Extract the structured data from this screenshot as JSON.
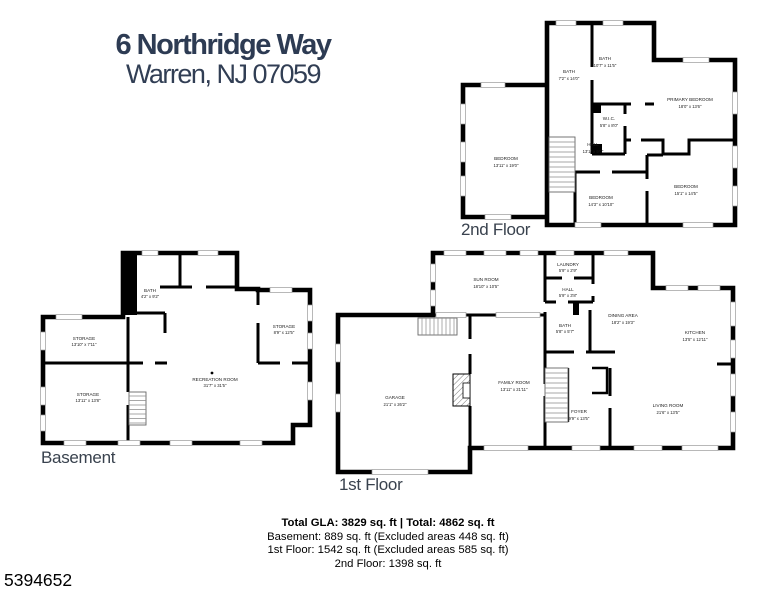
{
  "title": {
    "line1": "6 Northridge Way",
    "line2": "Warren, NJ 07059"
  },
  "colors": {
    "title_text": "#2d3b53",
    "floor_label_text": "#39424e",
    "walls": "#000000",
    "background": "#ffffff"
  },
  "floors": {
    "second": {
      "label": "2nd Floor",
      "rooms": [
        {
          "name": "BATH",
          "dims": "7'2\" x 14'0\""
        },
        {
          "name": "BATH",
          "dims": "10'7\" x 11'5\""
        },
        {
          "name": "PRIMARY BEDROOM",
          "dims": "18'0\" x 13'6\""
        },
        {
          "name": "W.I.C.",
          "dims": "5'8\" x 8'0\""
        },
        {
          "name": "HALL",
          "dims": "13'1\" x 9'0\""
        },
        {
          "name": "BEDROOM",
          "dims": "13'11\" x 19'0\""
        },
        {
          "name": "BEDROOM",
          "dims": "14'3\" x 10'10\""
        },
        {
          "name": "BEDROOM",
          "dims": "15'1\" x 14'5\""
        }
      ]
    },
    "basement": {
      "label": "Basement",
      "rooms": [
        {
          "name": "BATH",
          "dims": "4'2\" x 9'2\""
        },
        {
          "name": "STORAGE",
          "dims": "13'10\" x 7'11\""
        },
        {
          "name": "STORAGE",
          "dims": "13'11\" x 13'8\""
        },
        {
          "name": "STORAGE",
          "dims": "8'9\" x 12'5\""
        },
        {
          "name": "RECREATION ROOM",
          "dims": "31'7\" x 31'5\""
        }
      ]
    },
    "first": {
      "label": "1st Floor",
      "rooms": [
        {
          "name": "SUN ROOM",
          "dims": "18'10\" x 10'5\""
        },
        {
          "name": "LAUNDRY",
          "dims": "5'9\" x 2'9\""
        },
        {
          "name": "HALL",
          "dims": "5'9\" x 3'8\""
        },
        {
          "name": "BATH",
          "dims": "5'8\" x 5'7\""
        },
        {
          "name": "DINING AREA",
          "dims": "18'2\" x 19'3\""
        },
        {
          "name": "KITCHEN",
          "dims": "13'5\" x 12'11\""
        },
        {
          "name": "FAMILY ROOM",
          "dims": "13'11\" x 21'11\""
        },
        {
          "name": "GARAGE",
          "dims": "21'1\" x 26'2\""
        },
        {
          "name": "FOYER",
          "dims": "9'9\" x 13'5\""
        },
        {
          "name": "LIVING ROOM",
          "dims": "21'6\" x 13'5\""
        }
      ]
    }
  },
  "summary": {
    "total": "Total GLA: 3829 sq. ft | Total: 4862 sq. ft",
    "basement": "Basement: 889 sq. ft (Excluded areas 448 sq. ft)",
    "first": "1st Floor: 1542 sq. ft (Excluded areas 585 sq. ft)",
    "second": "2nd Floor: 1398 sq. ft"
  },
  "listing_id": "5394652"
}
